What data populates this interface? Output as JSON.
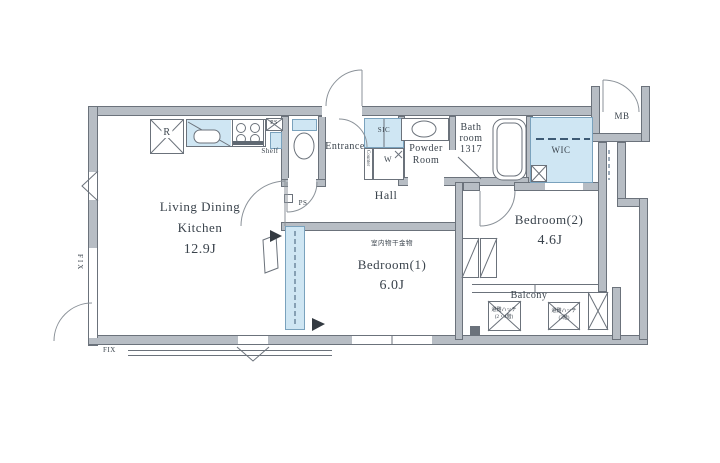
{
  "meta": {
    "type": "apartment-floor-plan"
  },
  "rooms": {
    "ldk": {
      "line1": "Living Dining",
      "line2": "Kitchen",
      "size": "12.9J"
    },
    "bedroom1": {
      "name": "Bedroom(1)",
      "size": "6.0J",
      "annotation": "室内物干金物"
    },
    "bedroom2": {
      "name": "Bedroom(2)",
      "size": "4.6J"
    },
    "hall": {
      "name": "Hall"
    },
    "entrance": {
      "name": "Entrance"
    },
    "powder_room": {
      "line1": "Powder",
      "line2": "Room"
    },
    "bathroom": {
      "line1": "Bath",
      "line2": "room",
      "line3": "1317"
    },
    "wic": {
      "name": "WIC"
    },
    "mb": {
      "name": "MB"
    },
    "balcony": {
      "name": "Balcony"
    }
  },
  "fixtures": {
    "refrigerator": "R",
    "shelf": "Shelf",
    "sic": "SIC",
    "washer": "W",
    "counter": "Counter",
    "pipe_space_top": "PS",
    "pipe_space_hall": "PS"
  },
  "windows": {
    "fix_left": "FIX",
    "fix_bottom": "FIX"
  },
  "balcony_items": {
    "hatch1": {
      "line1": "避難ハッチ",
      "line2": "(2・4階)"
    },
    "hatch2": {
      "line1": "避難ハッチ",
      "line2": "(3階)"
    }
  },
  "colors": {
    "wall": "#b7bdc4",
    "wall_line": "#6b727b",
    "fixture_blue": "#cfe6f3",
    "dashed_accent": "#3d5a74",
    "text": "#3a434c"
  }
}
